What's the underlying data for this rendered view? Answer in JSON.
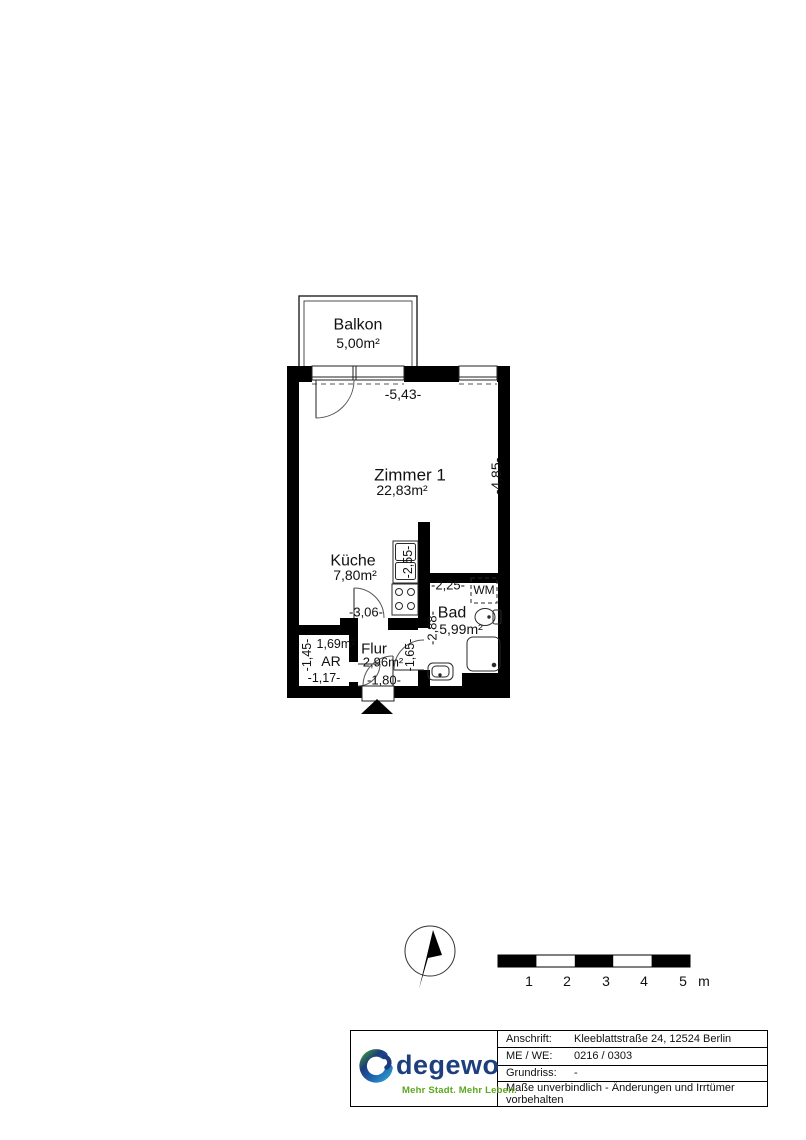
{
  "floorplan": {
    "balcony": {
      "name": "Balkon",
      "area": "5,00m²"
    },
    "rooms": {
      "zimmer1": {
        "name": "Zimmer 1",
        "area": "22,83m²"
      },
      "kueche": {
        "name": "Küche",
        "area": "7,80m²"
      },
      "bad": {
        "name": "Bad",
        "area": "5,99m²"
      },
      "flur": {
        "name": "Flur",
        "area": "2,96m²"
      },
      "ar": {
        "name": "AR",
        "area": "1,69m²"
      }
    },
    "appliances": {
      "washing_machine": "WM"
    },
    "dimensions": {
      "room_width": "-5,43-",
      "room_height": "-4,85-",
      "kitchen_unit": "-2,55-",
      "kitchen_width": "-3,06-",
      "bad_width": "-2,25-",
      "bad_height": "-2,88-",
      "flur_height": "-1,65-",
      "flur_width": "-1,80-",
      "ar_height": "-1,45-",
      "ar_width": "-1,17-"
    }
  },
  "scalebar": {
    "ticks": [
      "1",
      "2",
      "3",
      "4",
      "5"
    ],
    "unit": "m"
  },
  "titleblock": {
    "logo": {
      "brand": "degewo",
      "tagline": "Mehr Stadt. Mehr Leben."
    },
    "rows": [
      {
        "label": "Anschrift:",
        "value": "Kleeblattstraße 24, 12524 Berlin"
      },
      {
        "label": "ME / WE:",
        "value": "0216 / 0303"
      },
      {
        "label": "Grundriss:",
        "value": "-"
      }
    ],
    "disclaimer": "Maße unverbindlich - Änderungen und Irrtümer vorbehalten"
  },
  "colors": {
    "plan_black": "#000000",
    "brand_blue": "#1e3f7d",
    "brand_green": "#3f9c35",
    "brand_cyan": "#2fa8d5",
    "tagline_green": "#5ca81f"
  }
}
